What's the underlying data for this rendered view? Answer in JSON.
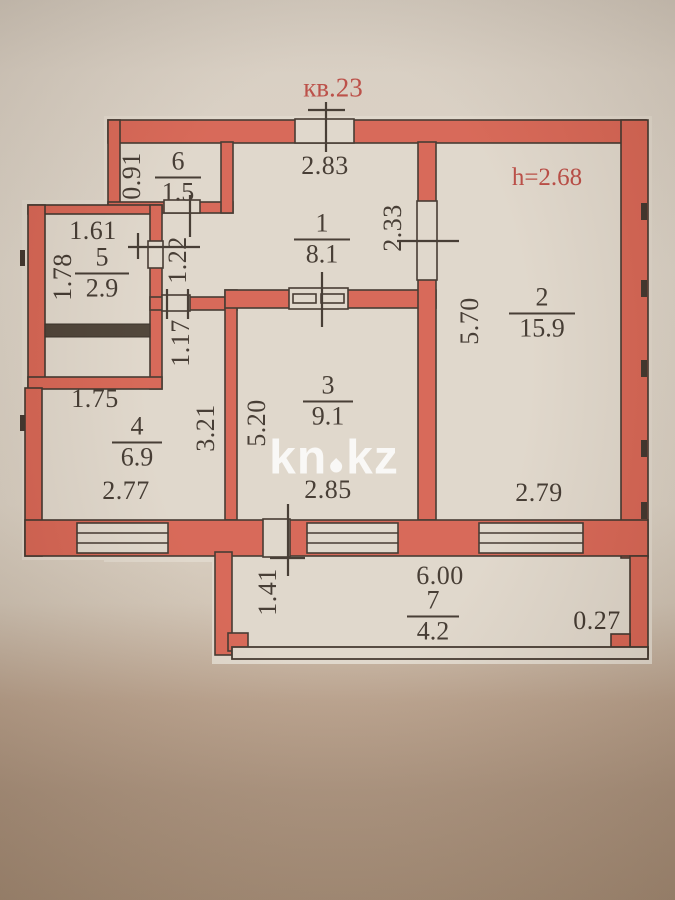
{
  "plan": {
    "apartment_label": "кв.23",
    "ceiling_height_label": "h=2.68",
    "watermark": {
      "left": "kn",
      "right": "kz",
      "full": "kn.kz"
    },
    "rooms": [
      {
        "number": "1",
        "area": "8.1"
      },
      {
        "number": "2",
        "area": "15.9"
      },
      {
        "number": "3",
        "area": "9.1"
      },
      {
        "number": "4",
        "area": "6.9"
      },
      {
        "number": "5",
        "area": "2.9"
      },
      {
        "number": "6",
        "area": "1.5"
      },
      {
        "number": "7",
        "area": "4.2"
      }
    ],
    "dimensions": {
      "room6_left": "0.91",
      "top_entry": "2.83",
      "room5_top": "1.61",
      "room5_left": "1.78",
      "corridor_upper": "1.22",
      "corridor_lower": "1.17",
      "room1_room2_door": "2.33",
      "room2_left": "5.70",
      "room4_top": "1.75",
      "room4_right": "3.21",
      "room3_left": "5.20",
      "room4_bottom": "2.77",
      "room3_bottom": "2.85",
      "room2_bottom": "2.79",
      "balcony_top": "6.00",
      "balcony_left": "1.41",
      "balcony_right": "0.27"
    },
    "colors": {
      "wall_fill": "#d55f4d",
      "paper": "#ded5c8",
      "ink": "#3a3027",
      "red_label": "#b7443c"
    }
  }
}
